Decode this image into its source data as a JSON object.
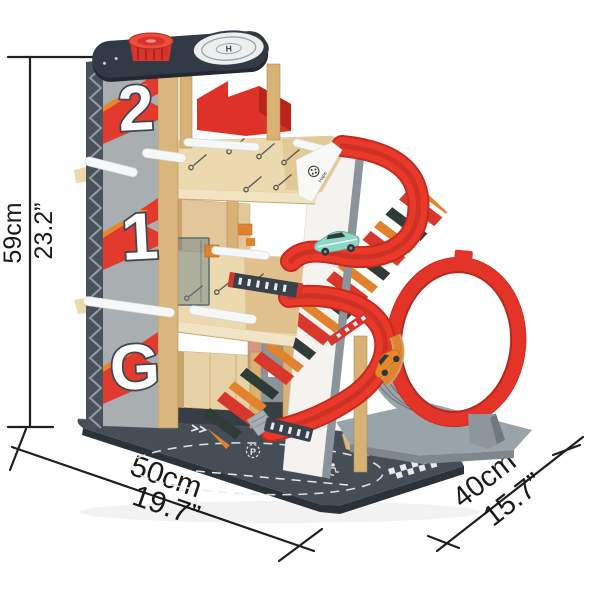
{
  "image": {
    "type": "product-photo",
    "subject": "wooden toy parking garage with spiral ramp, loop track and helipad, annotated with measurements"
  },
  "dimensions": {
    "height_cm": "59cm",
    "height_in": "23.2”",
    "width_cm": "50cm",
    "width_in": "19.7”",
    "depth_cm": "40cm",
    "depth_in": "15.7”"
  },
  "product": {
    "brand": "Hape",
    "level_labels": [
      "2",
      "1",
      "G"
    ],
    "helipad_letter": "H",
    "parking_letter": "P"
  },
  "colors": {
    "red": "#e23428",
    "dark_red": "#b7281c",
    "orange": "#e0832c",
    "wood_light": "#ecd9ae",
    "wood_mid": "#d9b67c",
    "tower_gray": "#a9aeb0",
    "navy": "#323b45",
    "base_charcoal": "#454d57",
    "stand_gray": "#99a3aa",
    "teal_car": "#8fd8c8",
    "annotation": "#1f1f1f"
  }
}
